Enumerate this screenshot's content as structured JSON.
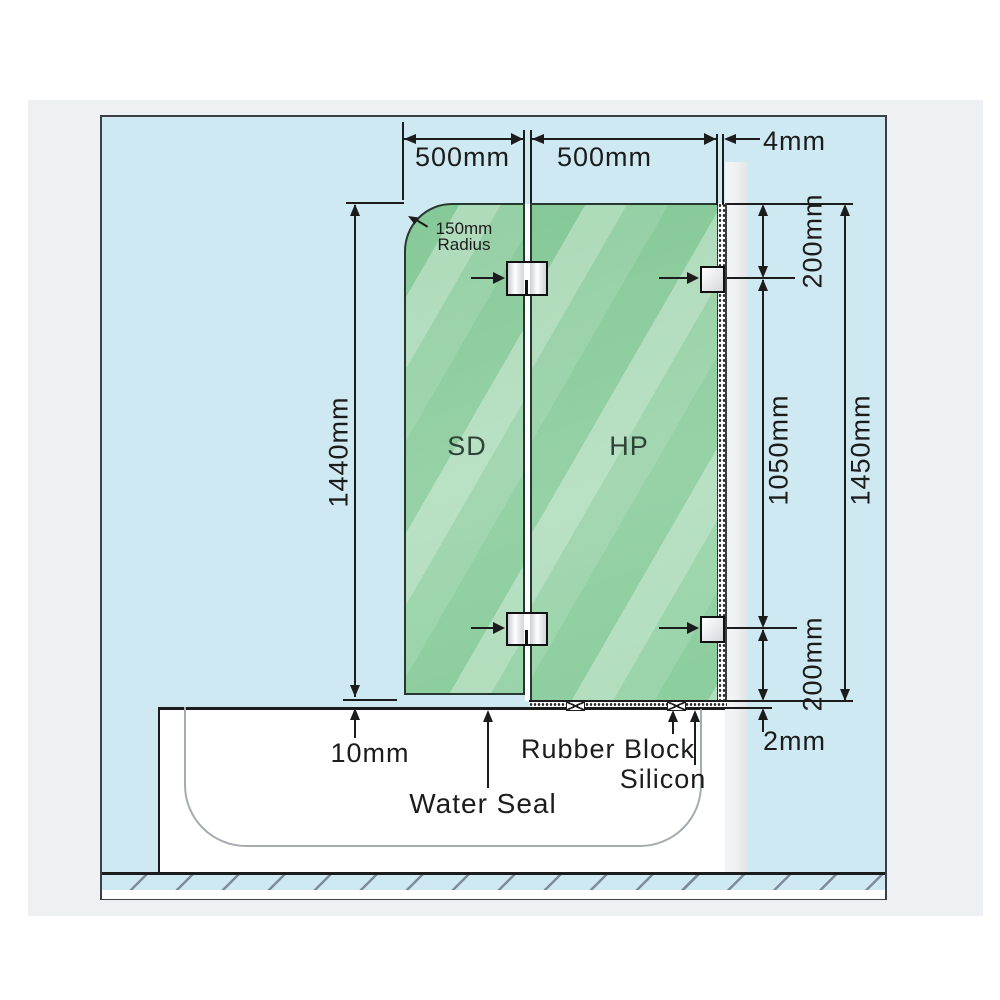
{
  "dimensions": {
    "sd_width": "500mm",
    "hp_width": "500mm",
    "wall_gap": "4mm",
    "glass_height": "1440mm",
    "corner_radius": "150mm",
    "corner_radius_label": "Radius",
    "top_offset": "200mm",
    "hinge_spacing": "1050mm",
    "overall_height": "1450mm",
    "bottom_offset": "200mm",
    "floor_gap": "10mm",
    "tub_gap": "2mm"
  },
  "panels": {
    "shower_door": "SD",
    "fixed_panel": "HP"
  },
  "callouts": {
    "water_seal": "Water Seal",
    "rubber_block": "Rubber Block",
    "silicon": "Silicon"
  },
  "colors": {
    "glass_green": "#8fcda0",
    "canvas_blue": "#cfe9f2",
    "wall_gray": "#e8eaec",
    "line_black": "#1c1c1c"
  }
}
